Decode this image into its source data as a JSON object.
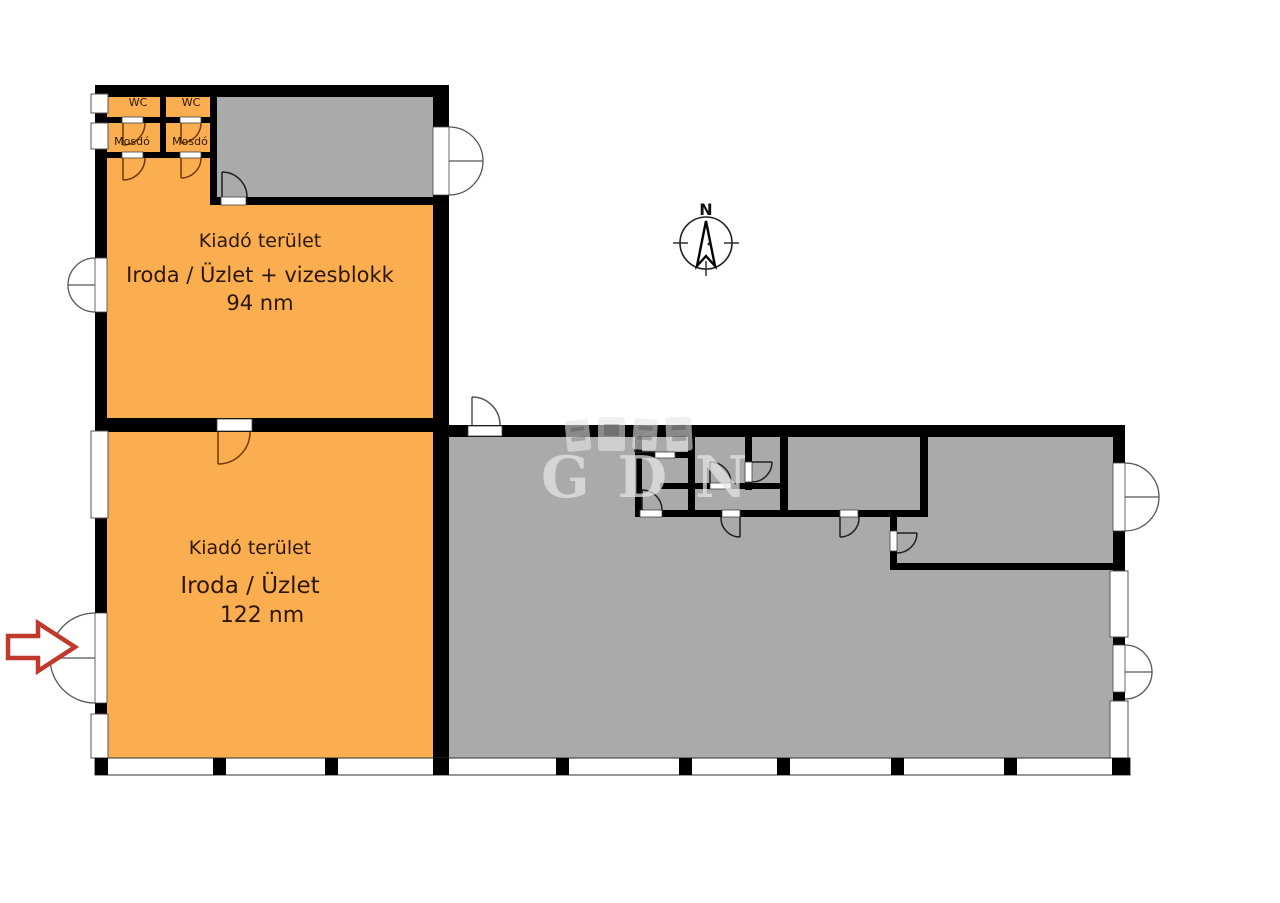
{
  "watermark": {
    "text": "GDN"
  },
  "compass": {
    "north_label": "N"
  },
  "units": {
    "unit94": {
      "line1": "Kiadó terület",
      "line2": "Iroda / Üzlet + vizesblokk",
      "line3": "94 nm"
    },
    "unit122": {
      "line1": "Kiadó terület",
      "line2": "Iroda / Üzlet",
      "line3": "122 nm"
    }
  },
  "rooms": {
    "wc_left": "WC",
    "wc_right": "WC",
    "mosdo_left": "Mosdó",
    "mosdo_right": "Mosdó"
  },
  "colors": {
    "rental_area": "#FBAE4F",
    "other_area": "#AAAAAA",
    "wall": "#000000",
    "door_arc_orange": "#6E3A00",
    "door_arc_gray": "#1F1F1F",
    "door_arc_exterior": "#555555",
    "arrow_red": "#C0392B",
    "label_text": "#2B1700"
  }
}
